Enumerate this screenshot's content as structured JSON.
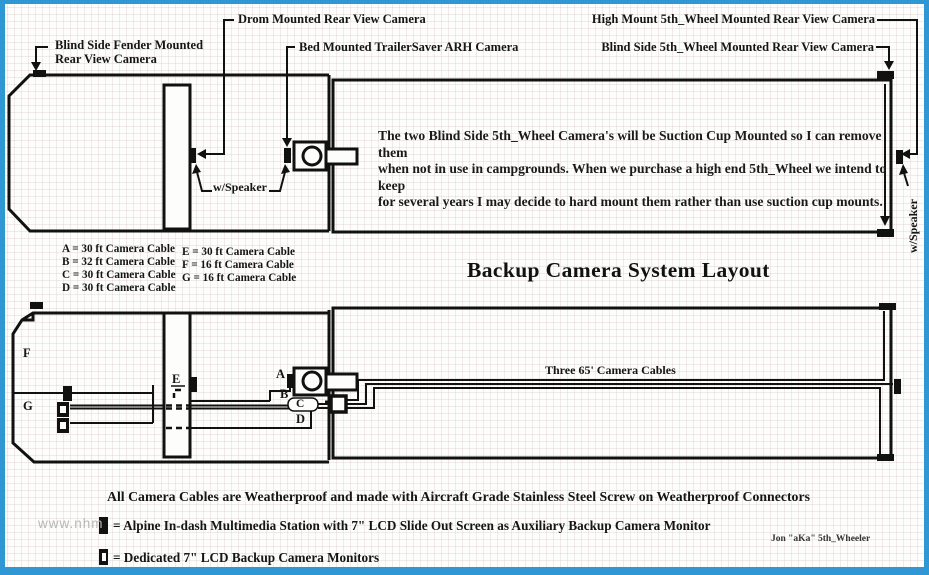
{
  "border_color": "#2f97d4",
  "title": "Backup Camera System Layout",
  "callouts": {
    "drom": "Drom Mounted Rear View Camera",
    "bed": "Bed Mounted TrailerSaver ARH Camera",
    "fender": "Blind Side Fender Mounted\nRear View Camera",
    "high_mount": "High Mount 5th_Wheel Mounted Rear View Camera",
    "blind_side": "Blind Side 5th_Wheel Mounted Rear View Camera",
    "w_speaker": "w/Speaker",
    "w_speaker_right": "w/Speaker"
  },
  "paragraph": "The two Blind Side 5th_Wheel Camera's will be Suction Cup Mounted so I can remove them\nwhen not in use in campgrounds. When we purchase a high end 5th_Wheel we intend to keep\nfor several years I may decide to hard mount them rather than use suction cup mounts.",
  "legend": {
    "col1": [
      "A = 30 ft Camera Cable",
      "B = 32 ft Camera Cable",
      "C = 30 ft Camera Cable",
      "D = 30 ft Camera Cable"
    ],
    "col2": [
      "E = 30 ft Camera Cable",
      "F = 16 ft Camera Cable",
      "G = 16 ft Camera Cable"
    ]
  },
  "cables": {
    "three_label": "Three 65' Camera Cables",
    "A": "A",
    "B": "B",
    "C": "C",
    "D": "D",
    "E": "E",
    "F": "F",
    "G": "G"
  },
  "footer": {
    "note": "All Camera Cables are Weatherproof and made with Aircraft Grade Stainless Steel Screw on Weatherproof Connectors",
    "alpine": "= Alpine In-dash Multimedia Station with 7\" LCD Slide Out Screen as Auxiliary Backup Camera Monitor",
    "dedicated": "= Dedicated 7\" LCD Backup Camera Monitors",
    "signature": "Jon \"aKa\" 5th_Wheeler",
    "watermark": "www.nhm"
  }
}
